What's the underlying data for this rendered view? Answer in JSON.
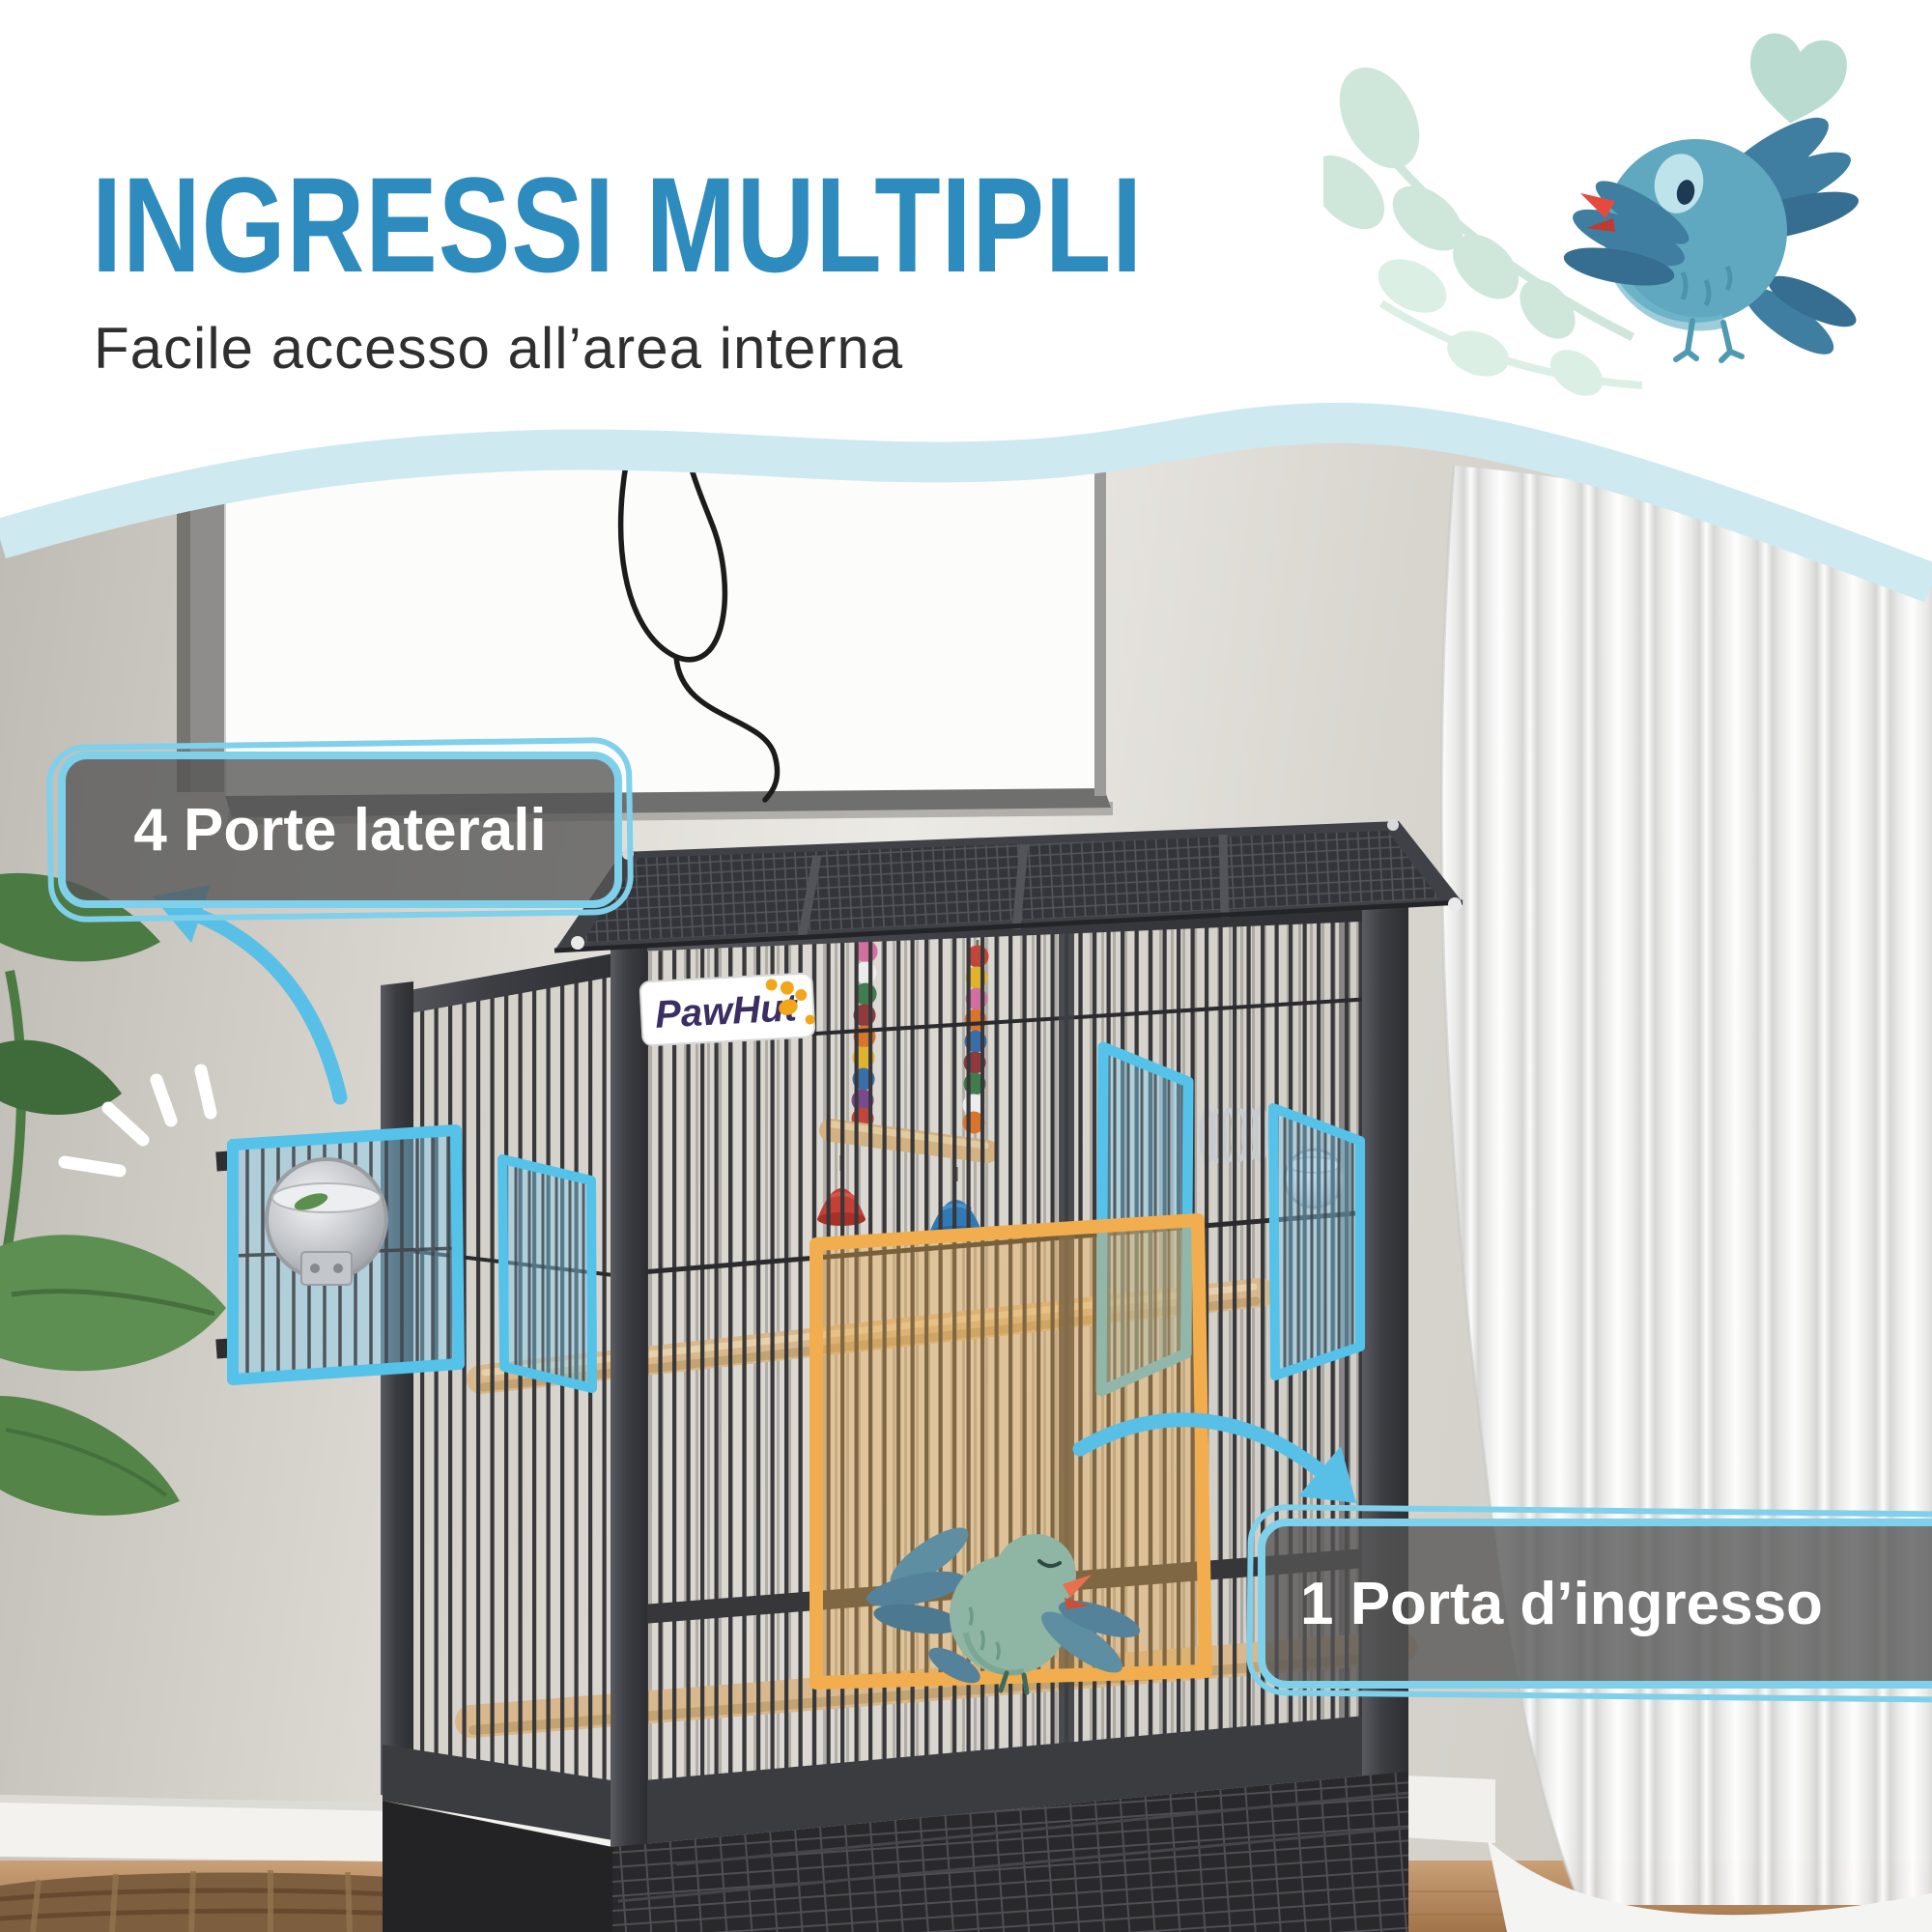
{
  "header": {
    "title": "INGRESSI MULTIPLI",
    "subtitle": "Facile accesso all’area interna"
  },
  "callouts": {
    "side_doors_label": "4 Porte laterali",
    "front_door_label": "1 Porta d’ingresso"
  },
  "brand": {
    "logo_text": "PawHut"
  },
  "icons": {
    "bird_illustration": "teal-bird-with-leaves-and-heart",
    "cage_bird": "green-singing-bird",
    "arrows": "curved-hand-drawn-arrow",
    "sparkle": "emphasis-rays"
  },
  "colors": {
    "title_blue": "#2e8bbd",
    "wave_blue": "#cfe9f1",
    "badge_border_blue": "#7fd0ea",
    "badge_bg_gray": "rgba(84,84,84,0.78)",
    "door_highlight_blue": "#55c2ea",
    "door_fill_blue": "rgba(130,205,235,0.45)",
    "door_highlight_orange": "#f2ae4e",
    "door_fill_orange": "rgba(228,170,80,0.42)",
    "accent_arrow_blue": "#58bfe6",
    "bird_teal": "#5fa8c0",
    "bird_wing_blue": "#3f7ea1",
    "bird_beak_red": "#e64a3e",
    "leaf_mint": "#cfe7db",
    "logo_purple": "#3a2e63",
    "logo_orange": "#f2a71b"
  }
}
